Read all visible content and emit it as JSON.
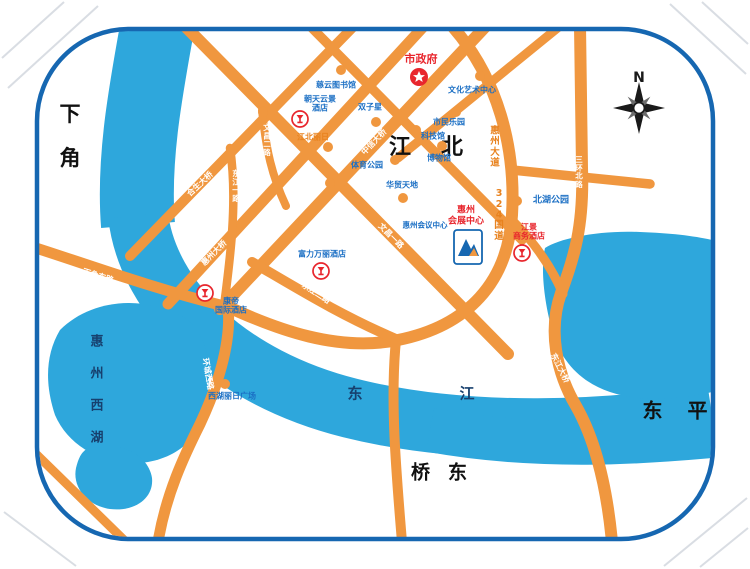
{
  "map": {
    "colors": {
      "water": "#2EA7DC",
      "road": "#F0973F",
      "border": "#1667B1",
      "poi_blue": "#1B6FC4",
      "poi_red": "#E8262D",
      "poi_orange": "#E8821E",
      "district_ink": "#111111",
      "water_ink": "#17406E",
      "road_label": "#FFFFFF"
    },
    "compass": {
      "label": "N",
      "x": 639,
      "y": 108
    },
    "region_labels": [
      {
        "id": "xiajiao",
        "text": "下角",
        "x": 70,
        "y": 135,
        "vertical": true,
        "step": 44,
        "size": 21,
        "color": "district_ink"
      },
      {
        "id": "jiangbei",
        "text": "江北",
        "x": 426,
        "y": 145,
        "vertical": false,
        "step": 52,
        "size": 22,
        "color": "district_ink"
      },
      {
        "id": "dongping",
        "text": "东平",
        "x": 675,
        "y": 409,
        "vertical": false,
        "step": 45,
        "size": 20,
        "color": "district_ink"
      },
      {
        "id": "qiaodong",
        "text": "桥东",
        "x": 439,
        "y": 471,
        "vertical": false,
        "step": 37,
        "size": 19,
        "color": "district_ink"
      },
      {
        "id": "west-lake",
        "text": "惠州西湖",
        "x": 97,
        "y": 388,
        "vertical": true,
        "step": 32,
        "size": 13,
        "color": "water_ink"
      },
      {
        "id": "dongjiang-river",
        "text": "东江",
        "x": 411,
        "y": 393,
        "vertical": false,
        "step": 112,
        "size": 15,
        "color": "water_ink"
      }
    ],
    "road_labels": [
      {
        "id": "hesheng-bridge",
        "text": "合生大桥",
        "x": 200,
        "y": 184,
        "rotate": -43,
        "size": 8,
        "style": "white"
      },
      {
        "id": "huizhou-bridge",
        "text": "惠州大桥",
        "x": 214,
        "y": 253,
        "rotate": -45,
        "size": 8,
        "style": "white"
      },
      {
        "id": "zhongxin-bridge",
        "text": "中信大桥",
        "x": 374,
        "y": 142,
        "rotate": -46,
        "size": 8,
        "style": "white"
      },
      {
        "id": "wenchang-1st-rd",
        "text": "文昌一路",
        "x": 391,
        "y": 236,
        "rotate": 45,
        "size": 8,
        "style": "white"
      },
      {
        "id": "wenchang-2nd-rd",
        "text": "文昌二路",
        "x": 267,
        "y": 140,
        "vertical": true,
        "size": 7.5,
        "style": "white"
      },
      {
        "id": "dongjiang-1st-rd",
        "text": "东江一路",
        "x": 236,
        "y": 186,
        "vertical": true,
        "size": 7.5,
        "style": "white"
      },
      {
        "id": "dongjiang-2nd-rd",
        "text": "东江二路",
        "x": 316,
        "y": 293,
        "rotate": 33,
        "size": 8,
        "style": "white"
      },
      {
        "id": "xiajiao-east-rd",
        "text": "下角东路",
        "x": 98,
        "y": 276,
        "rotate": 17,
        "size": 8,
        "style": "white"
      },
      {
        "id": "huancheng-west-rd",
        "text": "环城西路",
        "x": 208,
        "y": 374,
        "rotate": 80,
        "size": 8,
        "style": "white"
      },
      {
        "id": "sanhuan-north-rd",
        "text": "三环北路",
        "x": 579,
        "y": 172,
        "vertical": true,
        "size": 7.5,
        "style": "white"
      },
      {
        "id": "dongjiang-bridge",
        "text": "东江大桥",
        "x": 560,
        "y": 368,
        "rotate": 63,
        "size": 8,
        "style": "white"
      },
      {
        "id": "huizhou-avenue",
        "text": "惠州大道",
        "x": 495,
        "y": 147,
        "vertical": true,
        "size": 9.5,
        "style": "orange"
      },
      {
        "id": "g324",
        "text": "324国道",
        "x": 499,
        "y": 215,
        "vertical": true,
        "size": 9.5,
        "style": "orange"
      }
    ],
    "pois": [
      {
        "id": "city-government",
        "lines": [
          "市政府"
        ],
        "x": 421,
        "y": 60,
        "size": 11,
        "color": "red",
        "icon": {
          "type": "star",
          "x": 419,
          "y": 77
        }
      },
      {
        "id": "ciyun-library",
        "lines": [
          "慈云图书馆"
        ],
        "x": 336,
        "y": 85,
        "size": 8,
        "color": "blue",
        "dot": {
          "x": 341,
          "y": 70
        }
      },
      {
        "id": "yunjing-hotel",
        "lines": [
          "朝天云景",
          "酒店"
        ],
        "x": 320,
        "y": 104,
        "size": 8,
        "color": "blue",
        "icon": {
          "type": "hotel",
          "x": 300,
          "y": 119
        }
      },
      {
        "id": "twin-towers",
        "lines": [
          "双子星"
        ],
        "x": 370,
        "y": 107,
        "size": 8,
        "color": "blue",
        "dot": {
          "x": 376,
          "y": 122
        }
      },
      {
        "id": "culture-arts-center",
        "lines": [
          "文化艺术中心"
        ],
        "x": 472,
        "y": 90,
        "size": 8,
        "color": "blue",
        "dot": {
          "x": 480,
          "y": 76
        }
      },
      {
        "id": "citizens-park",
        "lines": [
          "市民乐园"
        ],
        "x": 449,
        "y": 122,
        "size": 8,
        "color": "blue",
        "dot": {
          "x": 456,
          "y": 112
        }
      },
      {
        "id": "science-museum",
        "lines": [
          "科技馆"
        ],
        "x": 433,
        "y": 136,
        "size": 8,
        "color": "blue",
        "dot": {
          "x": 416,
          "y": 130
        }
      },
      {
        "id": "museum",
        "lines": [
          "博物馆"
        ],
        "x": 439,
        "y": 158,
        "size": 8,
        "color": "blue",
        "dot": {
          "x": 442,
          "y": 146
        }
      },
      {
        "id": "sports-park",
        "lines": [
          "体育公园"
        ],
        "x": 367,
        "y": 165,
        "size": 8,
        "color": "blue",
        "dot": {
          "x": 395,
          "y": 160
        }
      },
      {
        "id": "huamao-tiandi",
        "lines": [
          "华贸天地"
        ],
        "x": 402,
        "y": 185,
        "size": 8,
        "color": "blue",
        "dot": {
          "x": 403,
          "y": 198
        }
      },
      {
        "id": "jiangbei-lirri",
        "lines": [
          "江北丽日"
        ],
        "x": 313,
        "y": 137,
        "size": 8,
        "color": "orange",
        "dot": {
          "x": 328,
          "y": 147
        }
      },
      {
        "id": "exhibition-center",
        "lines": [
          "惠州",
          "会展中心"
        ],
        "x": 466,
        "y": 216,
        "size": 9,
        "color": "red",
        "icon": {
          "type": "expo",
          "x": 468,
          "y": 247
        }
      },
      {
        "id": "conference-center",
        "lines": [
          "惠州会议中心"
        ],
        "x": 425,
        "y": 226,
        "size": 7.5,
        "color": "blue"
      },
      {
        "id": "beihu-park",
        "lines": [
          "北湖公园"
        ],
        "x": 551,
        "y": 201,
        "size": 9,
        "color": "blue",
        "dot": {
          "x": 517,
          "y": 201
        }
      },
      {
        "id": "riverview-hotel",
        "lines": [
          "江景",
          "商务酒店"
        ],
        "x": 529,
        "y": 232,
        "size": 8,
        "color": "red",
        "icon": {
          "type": "hotel",
          "x": 522,
          "y": 253
        }
      },
      {
        "id": "kande-hotel",
        "lines": [
          "康帝",
          "国际酒店"
        ],
        "x": 231,
        "y": 306,
        "size": 8,
        "color": "blue",
        "icon": {
          "type": "hotel",
          "x": 205,
          "y": 293
        }
      },
      {
        "id": "wanli-hotel",
        "lines": [
          "富力万丽酒店"
        ],
        "x": 322,
        "y": 254,
        "size": 8,
        "color": "blue",
        "icon": {
          "type": "hotel",
          "x": 321,
          "y": 271
        }
      },
      {
        "id": "xihu-lirri-plaza",
        "lines": [
          "西湖丽日广场"
        ],
        "x": 232,
        "y": 396,
        "size": 8,
        "color": "blue",
        "dot": {
          "x": 225,
          "y": 384
        }
      }
    ],
    "junction_dots": [
      {
        "x": 263,
        "y": 112
      },
      {
        "x": 330,
        "y": 183
      }
    ]
  }
}
